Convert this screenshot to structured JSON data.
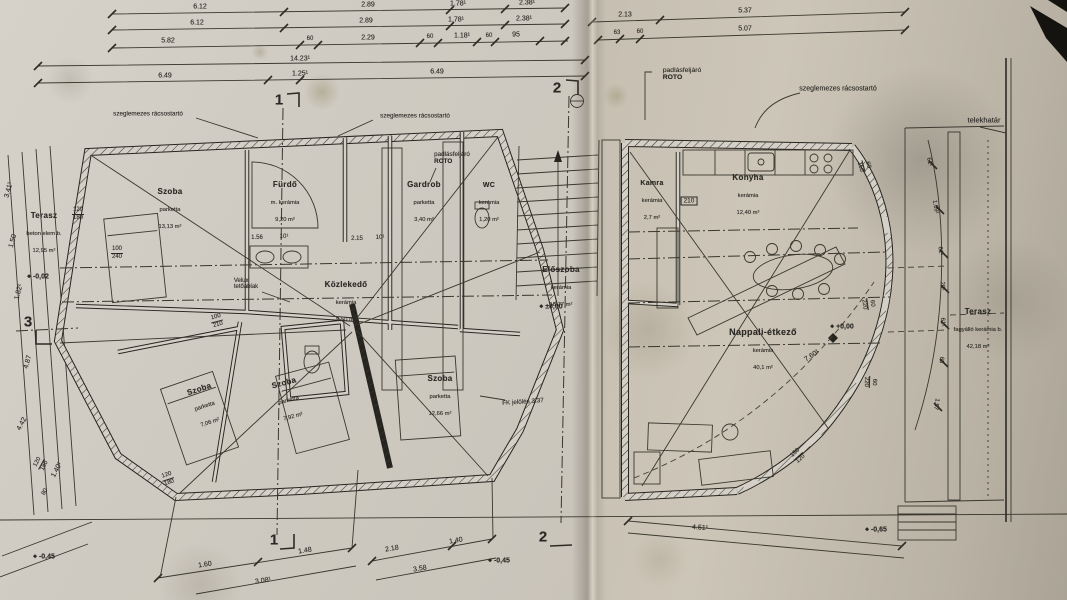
{
  "drawing": {
    "kind": "scanned architectural floor plan, ground floor, two joined sheets"
  },
  "annotations": {
    "truss_left": "szeglemezes rácsostartó",
    "truss_mid": "szeglemezes rácsostartó",
    "truss_right": "szeglemezes rácsostartó",
    "attic_left_1": "padlásfeljáró",
    "attic_left_2": "ROTO",
    "attic_right_1": "padlásfeljáró",
    "attic_right_2": "ROTO",
    "velux_1": "Velux",
    "velux_2": "tetőablak",
    "plot_boundary": "telekhatár",
    "roof_note": "FK jelölés 3.37"
  },
  "rooms": {
    "left": [
      {
        "name": "Terasz",
        "material": "beton elem b.",
        "area": "12,95 m²"
      },
      {
        "name": "Szoba",
        "material": "parketta",
        "area": "13,13 m²"
      },
      {
        "name": "Fürdő",
        "material": "m. kerámia",
        "area": "9,20 m²"
      },
      {
        "name": "Gardrob",
        "material": "parketta",
        "area": "3,40 m²"
      },
      {
        "name": "WC",
        "material": "kerámia",
        "area": "1,20 m²"
      },
      {
        "name": "Közlekedő",
        "material": "kerámia",
        "area": "9,50 m²"
      },
      {
        "name": "Előszoba",
        "material": "kerámia",
        "area": "18,77 m²"
      },
      {
        "name": "Szoba",
        "material": "parketta",
        "area": "7,06 m²"
      },
      {
        "name": "Szoba",
        "material": "parketta",
        "area": "7,92 m²"
      },
      {
        "name": "Szoba",
        "material": "parketta",
        "area": "12,66 m²"
      }
    ],
    "right": [
      {
        "name": "Kamra",
        "material": "kerámia",
        "area": "2,7 m²"
      },
      {
        "name": "Konyha",
        "material": "kerámia",
        "area": "12,40 m²"
      },
      {
        "name": "Nappali-étkező",
        "material": "kerámia",
        "area": "40,1 m²"
      },
      {
        "name": "Terasz",
        "material": "fagyálló kerámia b.",
        "area": "42,18 m²"
      }
    ]
  },
  "dims": {
    "top1": [
      "6.12",
      "2.89",
      "1.78¹",
      "2.38¹"
    ],
    "top2": [
      "6.12",
      "2.89",
      "1.78¹",
      "2.38¹"
    ],
    "top3": [
      "5.82",
      "60",
      "2.29",
      "60",
      "1.18¹",
      "60",
      "95"
    ],
    "top4": [
      "14.23¹"
    ],
    "top5": [
      "6.49",
      "1.25¹",
      "6.49"
    ],
    "topright1": [
      "2.13",
      "5.37"
    ],
    "topright2": [
      "63",
      "60",
      "5.07"
    ],
    "bottom1": [
      "1.60",
      "1.48",
      "3.08¹"
    ],
    "bottom2": [
      "2.18",
      "1.40",
      "3.58"
    ],
    "bottom3": "4.51¹",
    "diag": "7.60¹",
    "leftside": [
      "3.41¹",
      "1.50",
      "1.82¹",
      "4.87",
      "4.42",
      "1.40¹",
      "80"
    ],
    "arc": [
      "61¹",
      "1.09¹",
      "61¹",
      "20¹",
      "61¹",
      "63",
      "1.57"
    ],
    "small": [
      "1.56",
      "10¹",
      "2.15",
      "10¹"
    ]
  },
  "openings": [
    {
      "w": "120",
      "h": "180"
    },
    {
      "w": "100",
      "h": "240"
    },
    {
      "w": "100",
      "h": "210"
    },
    {
      "w": "120",
      "h": "180"
    },
    {
      "w": "210",
      "h": ""
    },
    {
      "w": "60",
      "h": "150"
    },
    {
      "w": "60",
      "h": "220"
    },
    {
      "w": "60",
      "h": "220"
    },
    {
      "w": "150",
      "h": "120"
    },
    {
      "w": "120",
      "h": "180"
    }
  ],
  "levels": {
    "entry": "±0,00",
    "terrace_left": "-0,02",
    "living": "+0,00",
    "out_left": "-0,45",
    "out_mid": "-0,45",
    "out_right": "-0,65"
  },
  "sections": {
    "s1": "1",
    "s1b": "1",
    "s2": "2",
    "s2b": "2",
    "s3": "3"
  },
  "colors": {
    "paper_left": "#d2cec6",
    "paper_right": "#c7bfb2",
    "ink": "#2b2925",
    "stain": "#9a8a6d"
  }
}
